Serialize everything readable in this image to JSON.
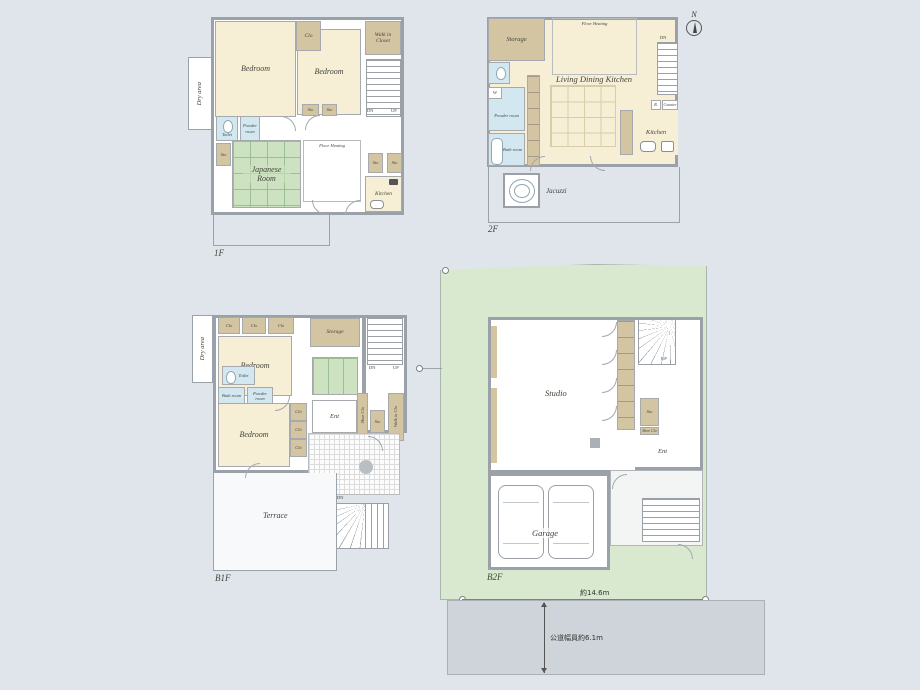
{
  "palette": {
    "background": "#dfe5eb",
    "wall_gray": "#9ba1a8",
    "room_cream": "#f6efd5",
    "closet_tan": "#d3c5a2",
    "tatami_green": "#cde2c1",
    "wet_blue": "#d2e7f0",
    "lot_green": "#d8e9cf",
    "road_gray": "#ced4d9"
  },
  "terms": {
    "bedroom": "Bedroom",
    "clo": "Clo",
    "sto": "Sto",
    "storage": "Storage",
    "walk_in_closet": "Walk in Closet",
    "walk_in_clo": "Walk in Clo",
    "shoe_clo": "Shoe Clo",
    "dry_area": "Dry area",
    "toilet": "Toilet",
    "powder_room": "Powder room",
    "bath_room": "Bath room",
    "japanese_room": "Japanese Room",
    "floor_heating": "Floor Heating",
    "kitchen": "Kitchen",
    "living_dining_kitchen": "Living Dining Kitchen",
    "jacuzzi": "Jacuzzi",
    "terrace": "Terrace",
    "studio": "Studio",
    "garage": "Garage",
    "ent": "Ent",
    "washer": "W",
    "fridge": "R.",
    "counter": "Counter",
    "up": "UP",
    "dn": "DN",
    "north": "N"
  },
  "floors": {
    "f1": {
      "label": "1F"
    },
    "f2": {
      "label": "2F"
    },
    "b1f": {
      "label": "B1F"
    },
    "b2f": {
      "label": "B2F"
    }
  },
  "site": {
    "frontage": "約14.6m",
    "road_width": "公道幅員約6.1m"
  }
}
